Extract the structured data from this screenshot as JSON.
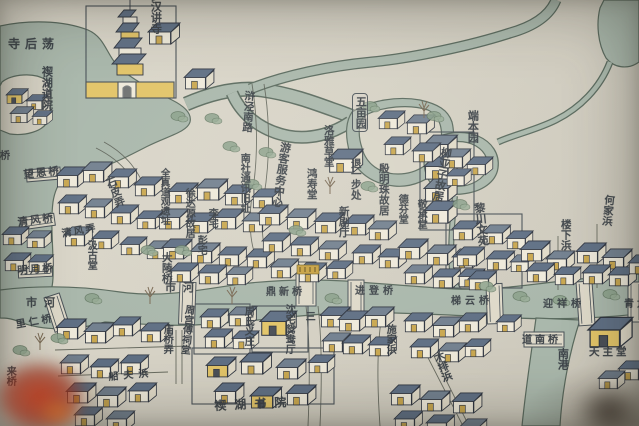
{
  "map": {
    "description_labels": "hand-painted Chinese town map photograph",
    "colors": {
      "paper": "#d8d4c6",
      "water": "#a9b7ab",
      "water_edge": "#5a6a5e",
      "ink": "#3a4046",
      "roof_blue": "#5f6f84",
      "roof_light": "#72808f",
      "wall_white": "#eee9da",
      "wall_yellow": "#e2c468",
      "door_yellow": "#c9a74f",
      "leaves_red": "#ba3a1c"
    },
    "labels": [
      {
        "id": "sihoudang-lake-label",
        "t": "寺后荡",
        "x": 8,
        "y": 38,
        "v": false,
        "s": 12,
        "r": 0,
        "sp": 5,
        "h": 0,
        "boxed": false
      },
      {
        "id": "xihu-daoyuan-label",
        "t": "禊湖道院",
        "x": 40,
        "y": 66,
        "v": true,
        "s": 11,
        "r": 0,
        "sp": 0,
        "h": 34,
        "boxed": false
      },
      {
        "id": "luohan-jiangsi-label",
        "t": "罗汉讲寺",
        "x": 149,
        "y": -10,
        "v": true,
        "s": 11,
        "r": 0,
        "sp": 0,
        "h": 0,
        "boxed": false
      },
      {
        "id": "hujing-south-road-label",
        "t": "浒泾南路",
        "x": 243,
        "y": 90,
        "v": true,
        "s": 10.5,
        "r": 4,
        "sp": 0,
        "h": 0,
        "boxed": false
      },
      {
        "id": "wumu-garden-label",
        "t": "五亩园",
        "x": 352,
        "y": 93,
        "v": true,
        "s": 11,
        "r": 0,
        "sp": 0,
        "h": 0,
        "boxed": true
      },
      {
        "id": "nanshe-site-label",
        "t": "南社通讯旧址",
        "x": 238,
        "y": 153,
        "v": true,
        "s": 10,
        "r": 0,
        "sp": 0,
        "h": 0,
        "boxed": false
      },
      {
        "id": "visitor-center-label",
        "t": "游客服务中心",
        "x": 279,
        "y": 141,
        "v": true,
        "s": 11,
        "r": 8,
        "sp": 0,
        "h": 0,
        "boxed": false
      },
      {
        "id": "luoya-caotang-label",
        "t": "洛雅草堂",
        "x": 322,
        "y": 125,
        "v": true,
        "s": 10.5,
        "r": 0,
        "sp": 0,
        "h": 0,
        "boxed": false
      },
      {
        "id": "hongshou-tang-label",
        "t": "鸿寿堂",
        "x": 305,
        "y": 168,
        "v": true,
        "s": 10.5,
        "r": 0,
        "sp": 0,
        "h": 0,
        "boxed": false
      },
      {
        "id": "tuiyibu-chu-label",
        "t": "退一步处",
        "x": 349,
        "y": 158,
        "v": true,
        "s": 10.5,
        "r": 0,
        "sp": 0,
        "h": 0,
        "boxed": false
      },
      {
        "id": "xinju-ting-label",
        "t": "新剧厅",
        "x": 337,
        "y": 206,
        "v": true,
        "s": 10.5,
        "r": 0,
        "sp": 0,
        "h": 0,
        "boxed": false
      },
      {
        "id": "yinmingzhu-guju-label",
        "t": "殷明珠故居",
        "x": 377,
        "y": 163,
        "v": true,
        "s": 10.5,
        "r": 0,
        "sp": 0,
        "h": 0,
        "boxed": false
      },
      {
        "id": "defen-tang-label",
        "t": "德芬堂",
        "x": 396,
        "y": 194,
        "v": true,
        "s": 10,
        "r": 0,
        "sp": 0,
        "h": 0,
        "boxed": false
      },
      {
        "id": "jingcheng-tang-label",
        "t": "敬承堂",
        "x": 415,
        "y": 199,
        "v": true,
        "s": 10,
        "r": 0,
        "sp": 0,
        "h": 0,
        "boxed": false
      },
      {
        "id": "liuyazi-guju-label",
        "t": "柳亚子故居",
        "x": 440,
        "y": 146,
        "v": true,
        "s": 11,
        "r": 10,
        "sp": 0,
        "h": 0,
        "boxed": false
      },
      {
        "id": "duanben-garden-label",
        "t": "端本园",
        "x": 466,
        "y": 110,
        "v": true,
        "s": 11,
        "r": 0,
        "sp": 0,
        "h": 0,
        "boxed": false
      },
      {
        "id": "lichuan-wenyuan-label",
        "t": "黎川文苑",
        "x": 472,
        "y": 203,
        "v": true,
        "s": 11,
        "r": -6,
        "sp": 0,
        "h": 0,
        "boxed": false
      },
      {
        "id": "hejia-bang-label",
        "t": "何家浜",
        "x": 603,
        "y": 194,
        "v": true,
        "s": 10.5,
        "r": 6,
        "sp": 0,
        "h": 0,
        "boxed": false
      },
      {
        "id": "louxia-bang-label",
        "t": "楼下浜",
        "x": 559,
        "y": 219,
        "v": true,
        "s": 10.5,
        "r": 0,
        "sp": 0,
        "h": 0,
        "boxed": false
      },
      {
        "id": "shipi-long-label",
        "t": "石皮弄",
        "x": 103,
        "y": 180,
        "v": true,
        "s": 10.5,
        "r": -22,
        "sp": 0,
        "h": 0,
        "boxed": false
      },
      {
        "id": "wangen-bridge-label",
        "t": "望恩桥",
        "x": 23,
        "y": 170,
        "v": false,
        "s": 10.5,
        "r": -6,
        "sp": 2,
        "h": 0,
        "boxed": false
      },
      {
        "id": "qingfeng-bridge-label",
        "t": "清风桥",
        "x": 17,
        "y": 218,
        "v": false,
        "s": 10.5,
        "r": -8,
        "sp": 2,
        "h": 0,
        "boxed": false
      },
      {
        "id": "qingfeng-long-label",
        "t": "清风弄",
        "x": 61,
        "y": 229,
        "v": false,
        "s": 10,
        "r": -10,
        "sp": 2,
        "h": 0,
        "boxed": false
      },
      {
        "id": "mingyue-bridge-label",
        "t": "明月桥",
        "x": 17,
        "y": 266,
        "v": false,
        "s": 10.5,
        "r": -4,
        "sp": 2,
        "h": 0,
        "boxed": false
      },
      {
        "id": "jigu-tang-label",
        "t": "汲古堂",
        "x": 85,
        "y": 240,
        "v": true,
        "s": 10,
        "r": 0,
        "sp": 0,
        "h": 0,
        "boxed": false
      },
      {
        "id": "quanzhen-daoguan-site-label",
        "t": "全真道观遗址",
        "x": 158,
        "y": 168,
        "v": true,
        "s": 9.5,
        "r": 0,
        "sp": 0,
        "h": 0,
        "boxed": false
      },
      {
        "id": "xudayuan-guju-label",
        "t": "徐达源故居",
        "x": 183,
        "y": 188,
        "v": true,
        "s": 10,
        "r": 0,
        "sp": 0,
        "h": 0,
        "boxed": false
      },
      {
        "id": "li-zhai-label",
        "t": "李宅",
        "x": 206,
        "y": 208,
        "v": true,
        "s": 10,
        "r": 0,
        "sp": 0,
        "h": 0,
        "boxed": false
      },
      {
        "id": "peng-zhai-label",
        "t": "彭宅",
        "x": 195,
        "y": 235,
        "v": true,
        "s": 10,
        "r": 0,
        "sp": 0,
        "h": 0,
        "boxed": false
      },
      {
        "id": "daling-bridge-label",
        "t": "大陵桥",
        "x": 160,
        "y": 252,
        "v": true,
        "s": 10.5,
        "r": 0,
        "sp": 0,
        "h": 0,
        "boxed": false
      },
      {
        "id": "shihe-river-west-label",
        "t": "市河",
        "x": 26,
        "y": 297,
        "v": false,
        "s": 11,
        "r": 0,
        "sp": 7,
        "h": 0,
        "boxed": false
      },
      {
        "id": "shihe-river-label",
        "t": "市河",
        "x": 165,
        "y": 282,
        "v": false,
        "s": 11,
        "r": 0,
        "sp": 7,
        "h": 0,
        "boxed": false
      },
      {
        "id": "dingxin-bridge-label",
        "t": "鼎新桥",
        "x": 266,
        "y": 287,
        "v": false,
        "s": 10,
        "r": 0,
        "sp": 3,
        "h": 0,
        "boxed": false
      },
      {
        "id": "jindeng-bridge-label",
        "t": "进登桥",
        "x": 355,
        "y": 286,
        "v": false,
        "s": 10,
        "r": 0,
        "sp": 4,
        "h": 0,
        "boxed": false
      },
      {
        "id": "tiyun-bridge-label",
        "t": "梯云桥",
        "x": 451,
        "y": 296,
        "v": false,
        "s": 10,
        "r": 0,
        "sp": 4,
        "h": 0,
        "boxed": false
      },
      {
        "id": "yingxiang-bridge-label",
        "t": "迎祥桥",
        "x": 543,
        "y": 299,
        "v": false,
        "s": 10,
        "r": 0,
        "sp": 4,
        "h": 0,
        "boxed": false
      },
      {
        "id": "qinglong-bridge-label",
        "t": "青龙桥",
        "x": 624,
        "y": 299,
        "v": false,
        "s": 10,
        "r": 0,
        "sp": 3,
        "h": 0,
        "boxed": false
      },
      {
        "id": "daonan-bridge-label",
        "t": "道南桥",
        "x": 522,
        "y": 335,
        "v": false,
        "s": 10,
        "r": 0,
        "sp": 3,
        "h": 0,
        "boxed": false
      },
      {
        "id": "nangang-river-label",
        "t": "南港",
        "x": 556,
        "y": 348,
        "v": true,
        "s": 11,
        "r": 0,
        "sp": 0,
        "h": 0,
        "boxed": false
      },
      {
        "id": "tianzhu-tang-label",
        "t": "天主堂",
        "x": 589,
        "y": 347,
        "v": false,
        "s": 10.5,
        "r": 0,
        "sp": 3,
        "h": 0,
        "boxed": false
      },
      {
        "id": "shenzhai-yuanyang-ting-label",
        "t": "沈宅鸳鸯厅",
        "x": 283,
        "y": 304,
        "v": true,
        "s": 10,
        "r": 0,
        "sp": 0,
        "h": 0,
        "boxed": false
      },
      {
        "id": "san-road-label",
        "t": "三",
        "x": 303,
        "y": 311,
        "v": true,
        "s": 10,
        "r": 0,
        "sp": 0,
        "h": 0,
        "boxed": false
      },
      {
        "id": "zhougongfu-citang-label",
        "t": "周宫傅祠堂",
        "x": 183,
        "y": 304,
        "v": true,
        "s": 10,
        "r": 6,
        "sp": 0,
        "h": 0,
        "boxed": false
      },
      {
        "id": "zhoushi-yizhuang-label",
        "t": "周氏义庄",
        "x": 242,
        "y": 306,
        "v": true,
        "s": 10,
        "r": 0,
        "sp": 0,
        "h": 0,
        "boxed": false
      },
      {
        "id": "miaoqiao-long-label",
        "t": "庙桥弄",
        "x": 161,
        "y": 324,
        "v": true,
        "s": 10,
        "r": 0,
        "sp": 0,
        "h": 0,
        "boxed": false
      },
      {
        "id": "xihu-shuyuan-label",
        "t": "禊湖书院",
        "x": 214,
        "y": 400,
        "v": false,
        "s": 12,
        "r": -3,
        "sp": 8,
        "h": 0,
        "boxed": false
      },
      {
        "id": "chuanfu-bang-label",
        "t": "船夫浜",
        "x": 108,
        "y": 372,
        "v": false,
        "s": 10,
        "r": -5,
        "sp": 5,
        "h": 0,
        "boxed": false
      },
      {
        "id": "shijia-bang-label",
        "t": "施家浜",
        "x": 384,
        "y": 324,
        "v": true,
        "s": 10,
        "r": 0,
        "sp": 0,
        "h": 0,
        "boxed": false
      },
      {
        "id": "mupai-bang-label",
        "t": "木排浜",
        "x": 431,
        "y": 354,
        "v": true,
        "s": 10.5,
        "r": -20,
        "sp": 0,
        "h": 0,
        "boxed": false
      },
      {
        "id": "liren-bridge-label",
        "t": "里仁桥",
        "x": 15,
        "y": 320,
        "v": false,
        "s": 10,
        "r": -10,
        "sp": 3,
        "h": 0,
        "boxed": false
      },
      {
        "id": "lai-bridge-partial-label",
        "t": "来桥",
        "x": 4,
        "y": 366,
        "v": true,
        "s": 10,
        "r": 0,
        "sp": 0,
        "h": 0,
        "boxed": false
      },
      {
        "id": "bridge-partial-west-label",
        "t": "桥",
        "x": 0,
        "y": 151,
        "v": false,
        "s": 10,
        "r": 0,
        "sp": 0,
        "h": 0,
        "boxed": false
      }
    ]
  }
}
